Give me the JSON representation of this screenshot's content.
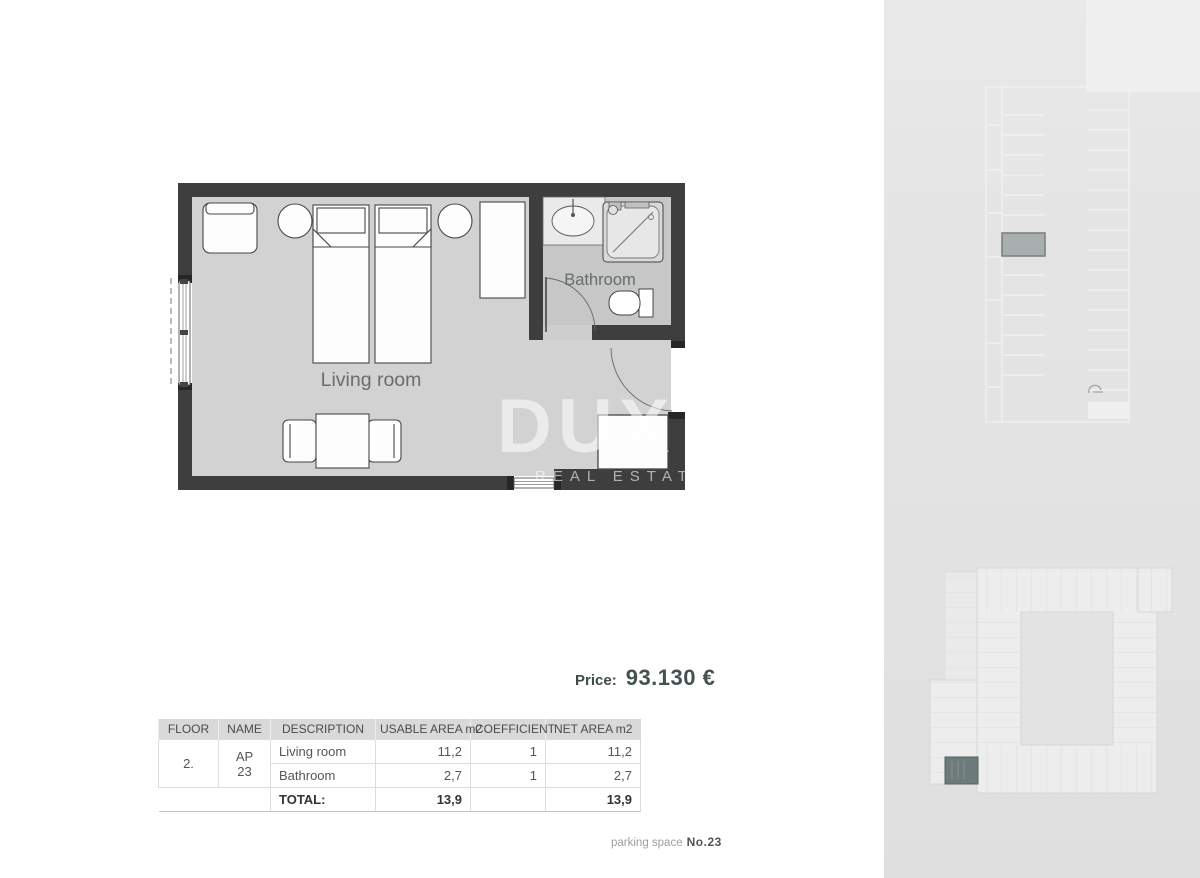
{
  "floor_plan": {
    "living_room_label": "Living room",
    "bathroom_label": "Bathroom"
  },
  "watermark": {
    "brand": "DUX",
    "tagline": "REAL ESTATE"
  },
  "price": {
    "label": "Price:",
    "value": "93.130 €"
  },
  "area_table": {
    "headers": [
      "FLOOR",
      "NAME",
      "DESCRIPTION",
      "USABLE AREA m2",
      "COEFFICIENT",
      "NET AREA m2"
    ],
    "floor": "2.",
    "name": "AP 23",
    "rows": [
      {
        "description": "Living room",
        "usable": "11,2",
        "coefficient": "1",
        "net": "11,2"
      },
      {
        "description": "Bathroom",
        "usable": "2,7",
        "coefficient": "1",
        "net": "2,7"
      }
    ],
    "total_label": "TOTAL:",
    "total_usable": "13,9",
    "total_net": "13,9"
  },
  "footer": {
    "parking_label": "parking space",
    "parking_number": "No.23"
  },
  "icons": {
    "parking_entry": "car-entry-icon"
  },
  "colors": {
    "wall": "#3e3e3e",
    "living_floor": "#d2d2d2",
    "bathroom_floor": "#c7c7c7",
    "sidebar_bg": "#e4e4e4",
    "parking_highlight": "#a9aeae",
    "unit_highlight": "#6e7b7b",
    "price_text": "#3d4b4b",
    "table_header_bg": "#d9d9d9"
  }
}
